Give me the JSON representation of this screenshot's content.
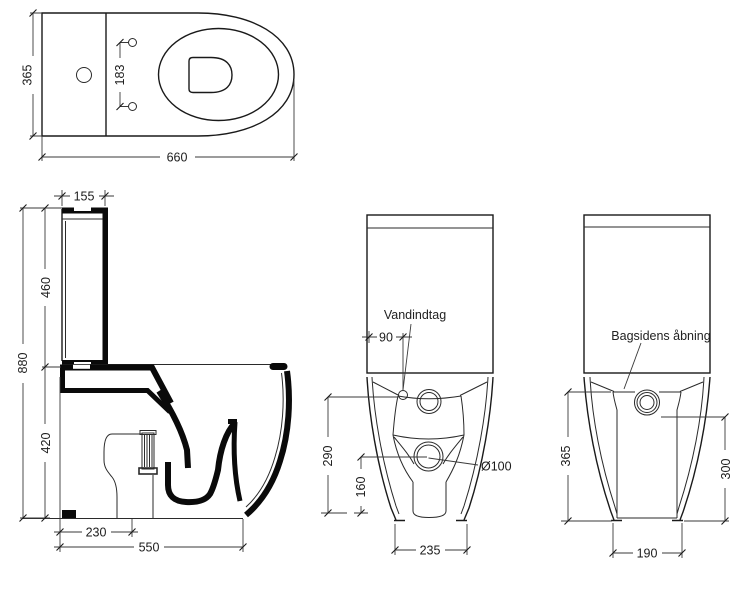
{
  "meta": {
    "background": "#ffffff",
    "line_color": "#1a1a1a",
    "drawing_type": "toilet technical dimension drawing"
  },
  "views": {
    "top": {
      "dims": {
        "width_overall": "365",
        "hinge_spacing": "183",
        "depth_overall": "660"
      }
    },
    "side": {
      "dims": {
        "tank_depth": "155",
        "tank_height": "460",
        "total_height": "880",
        "bowl_height": "420",
        "outlet_offset": "230",
        "depth_floor": "550"
      }
    },
    "front": {
      "annotation": "Vandindtag",
      "dims": {
        "inlet_offset": "90",
        "inlet_height": "290",
        "outlet_height": "160",
        "outlet_diameter": "Ø100",
        "foot_width": "235"
      }
    },
    "back": {
      "annotation": "Bagsidens åbning",
      "dims": {
        "opening_height": "365",
        "opening_height_right": "300",
        "foot_width": "190"
      }
    }
  }
}
